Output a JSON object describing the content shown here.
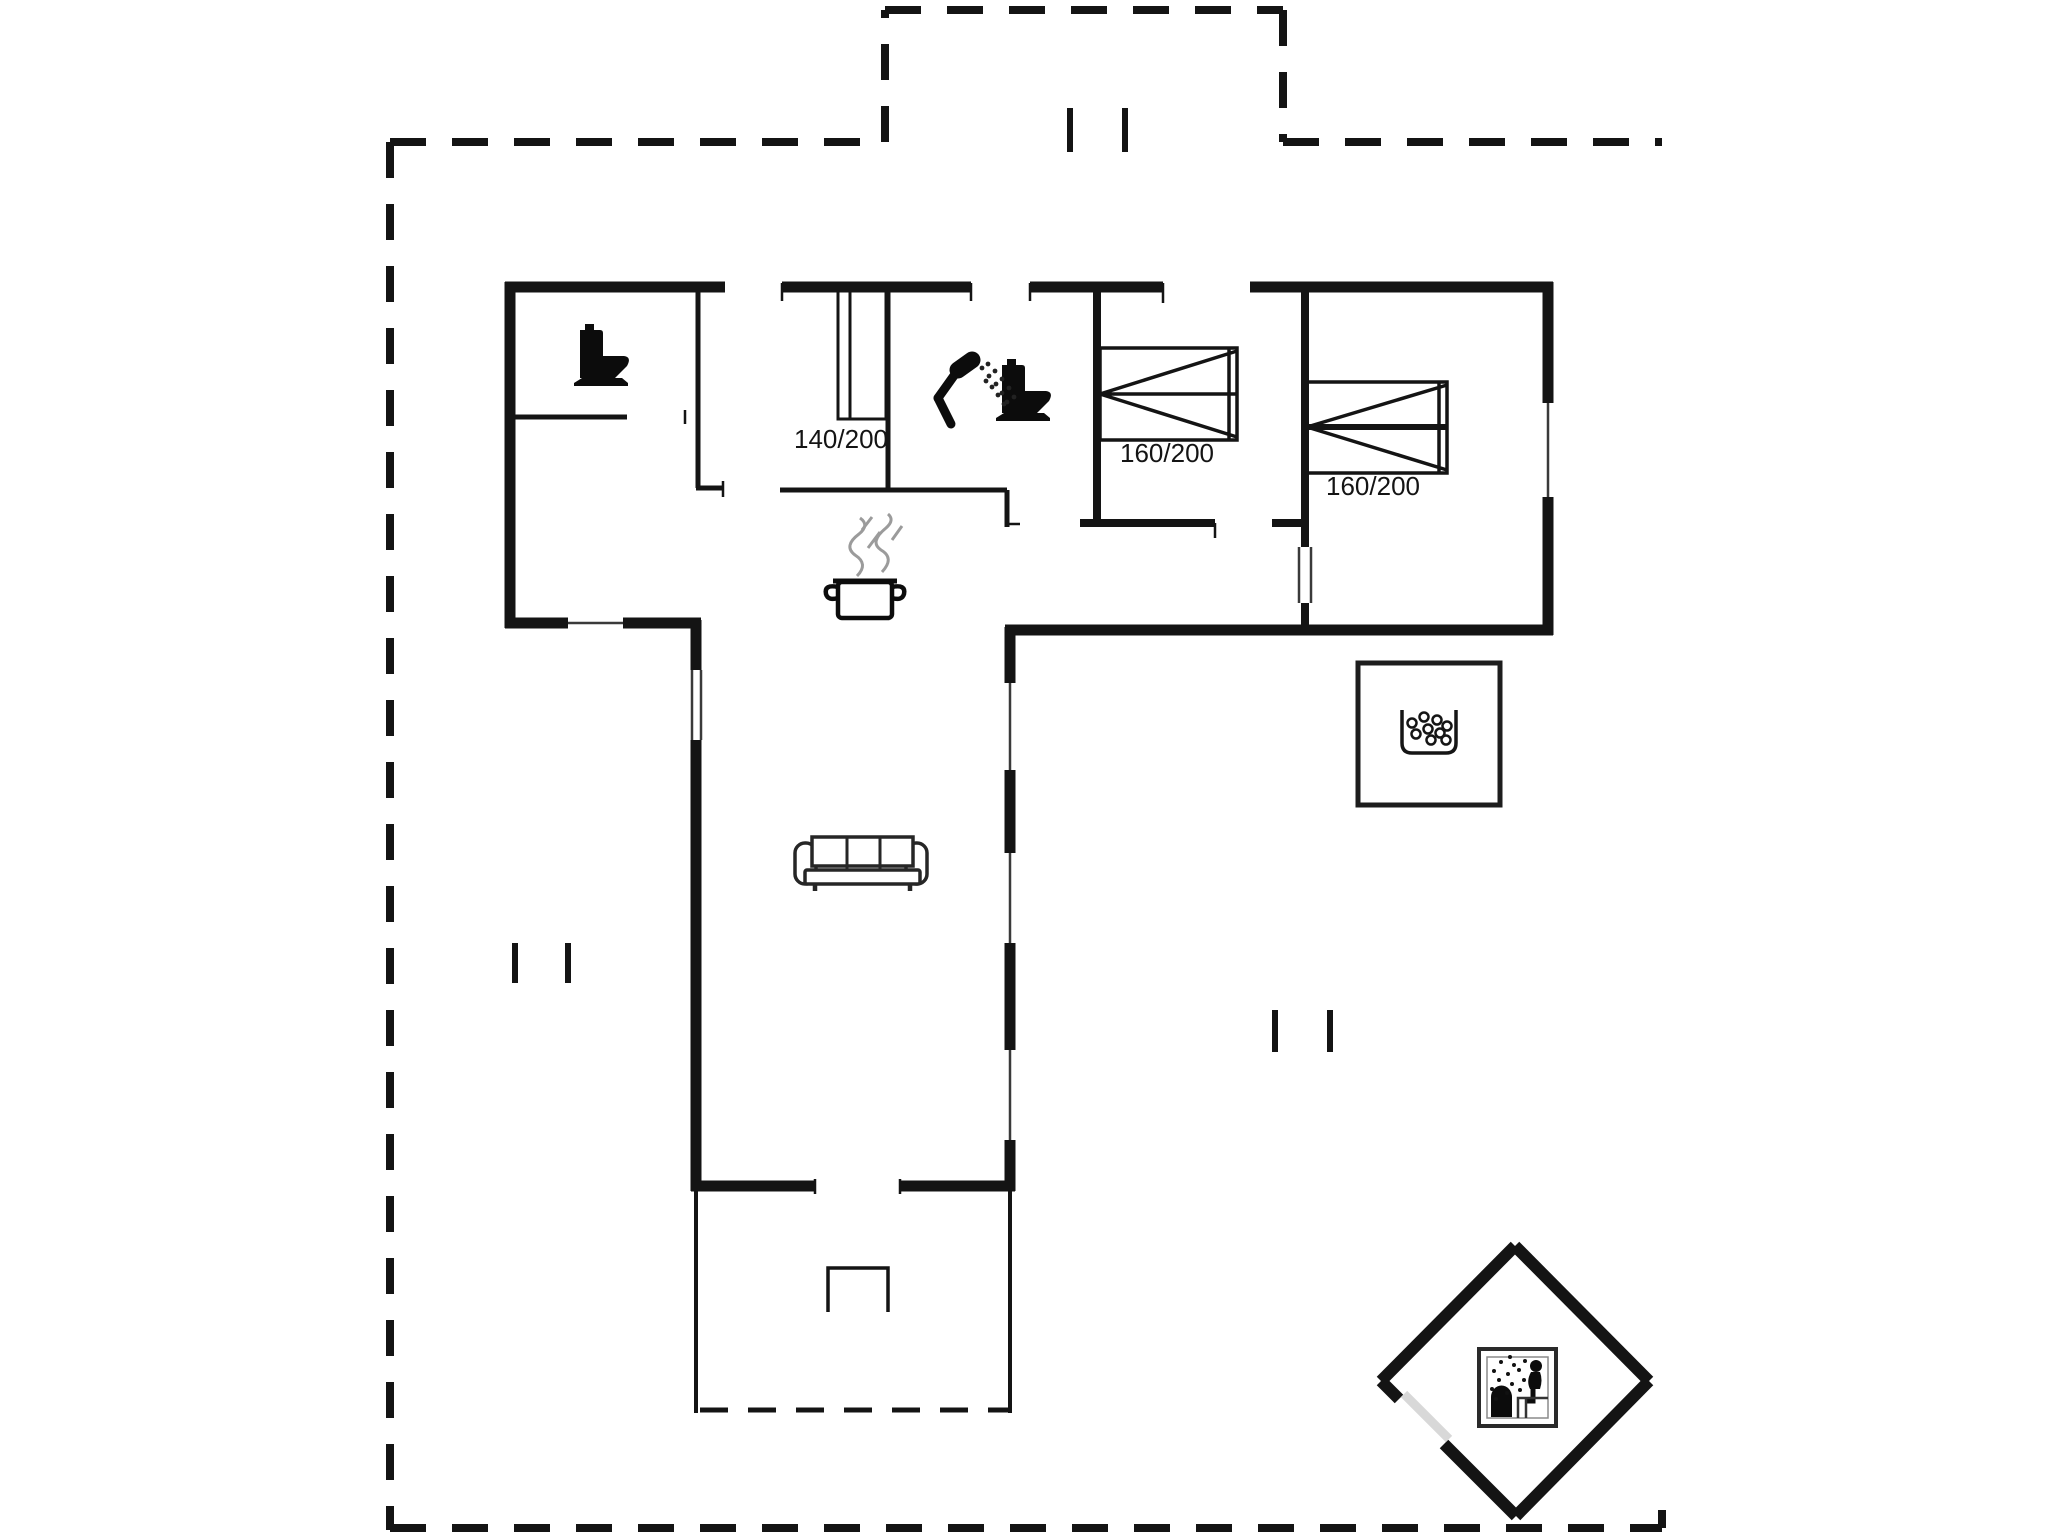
{
  "page": {
    "type": "floor-plan-drawing",
    "background": "#ffffff",
    "ink_color": "#141414",
    "steam_color": "#9b9b9b",
    "door_leaf_color": "#d8d8d8"
  },
  "labels": [
    {
      "id": "bed-140-label",
      "text": "140/200"
    },
    {
      "id": "bed-160-a-label",
      "text": "160/200"
    },
    {
      "id": "bed-160-b-label",
      "text": "160/200"
    }
  ],
  "icons": [
    {
      "name": "toilet-icon",
      "meaning": "toilet / WC",
      "shape": "black toilet silhouette",
      "count": 2
    },
    {
      "name": "shower-icon",
      "meaning": "shower",
      "shape": "hand shower with spray dots"
    },
    {
      "name": "cooking-pot-icon",
      "meaning": "kitchen / stove",
      "shape": "pot with two handles"
    },
    {
      "name": "steam-icon",
      "meaning": "steam over pot",
      "shape": "gray squiggles"
    },
    {
      "name": "sofa-icon",
      "meaning": "living-room sofa",
      "shape": "three-seat sofa top view"
    },
    {
      "name": "whirlpool-icon",
      "meaning": "whirlpool / hot tub",
      "shape": "tub with bubbles in square room"
    },
    {
      "name": "sauna-icon",
      "meaning": "sauna",
      "shape": "person on bench with sauna stove, diamond room"
    },
    {
      "name": "entrance-marker",
      "meaning": "entrance / path marks",
      "shape": "double tick marks",
      "count": 3
    }
  ],
  "beds": [
    {
      "id": "bed-140",
      "size_label": "140/200"
    },
    {
      "id": "bed-160-a",
      "size_label": "160/200"
    },
    {
      "id": "bed-160-b",
      "size_label": "160/200"
    }
  ]
}
